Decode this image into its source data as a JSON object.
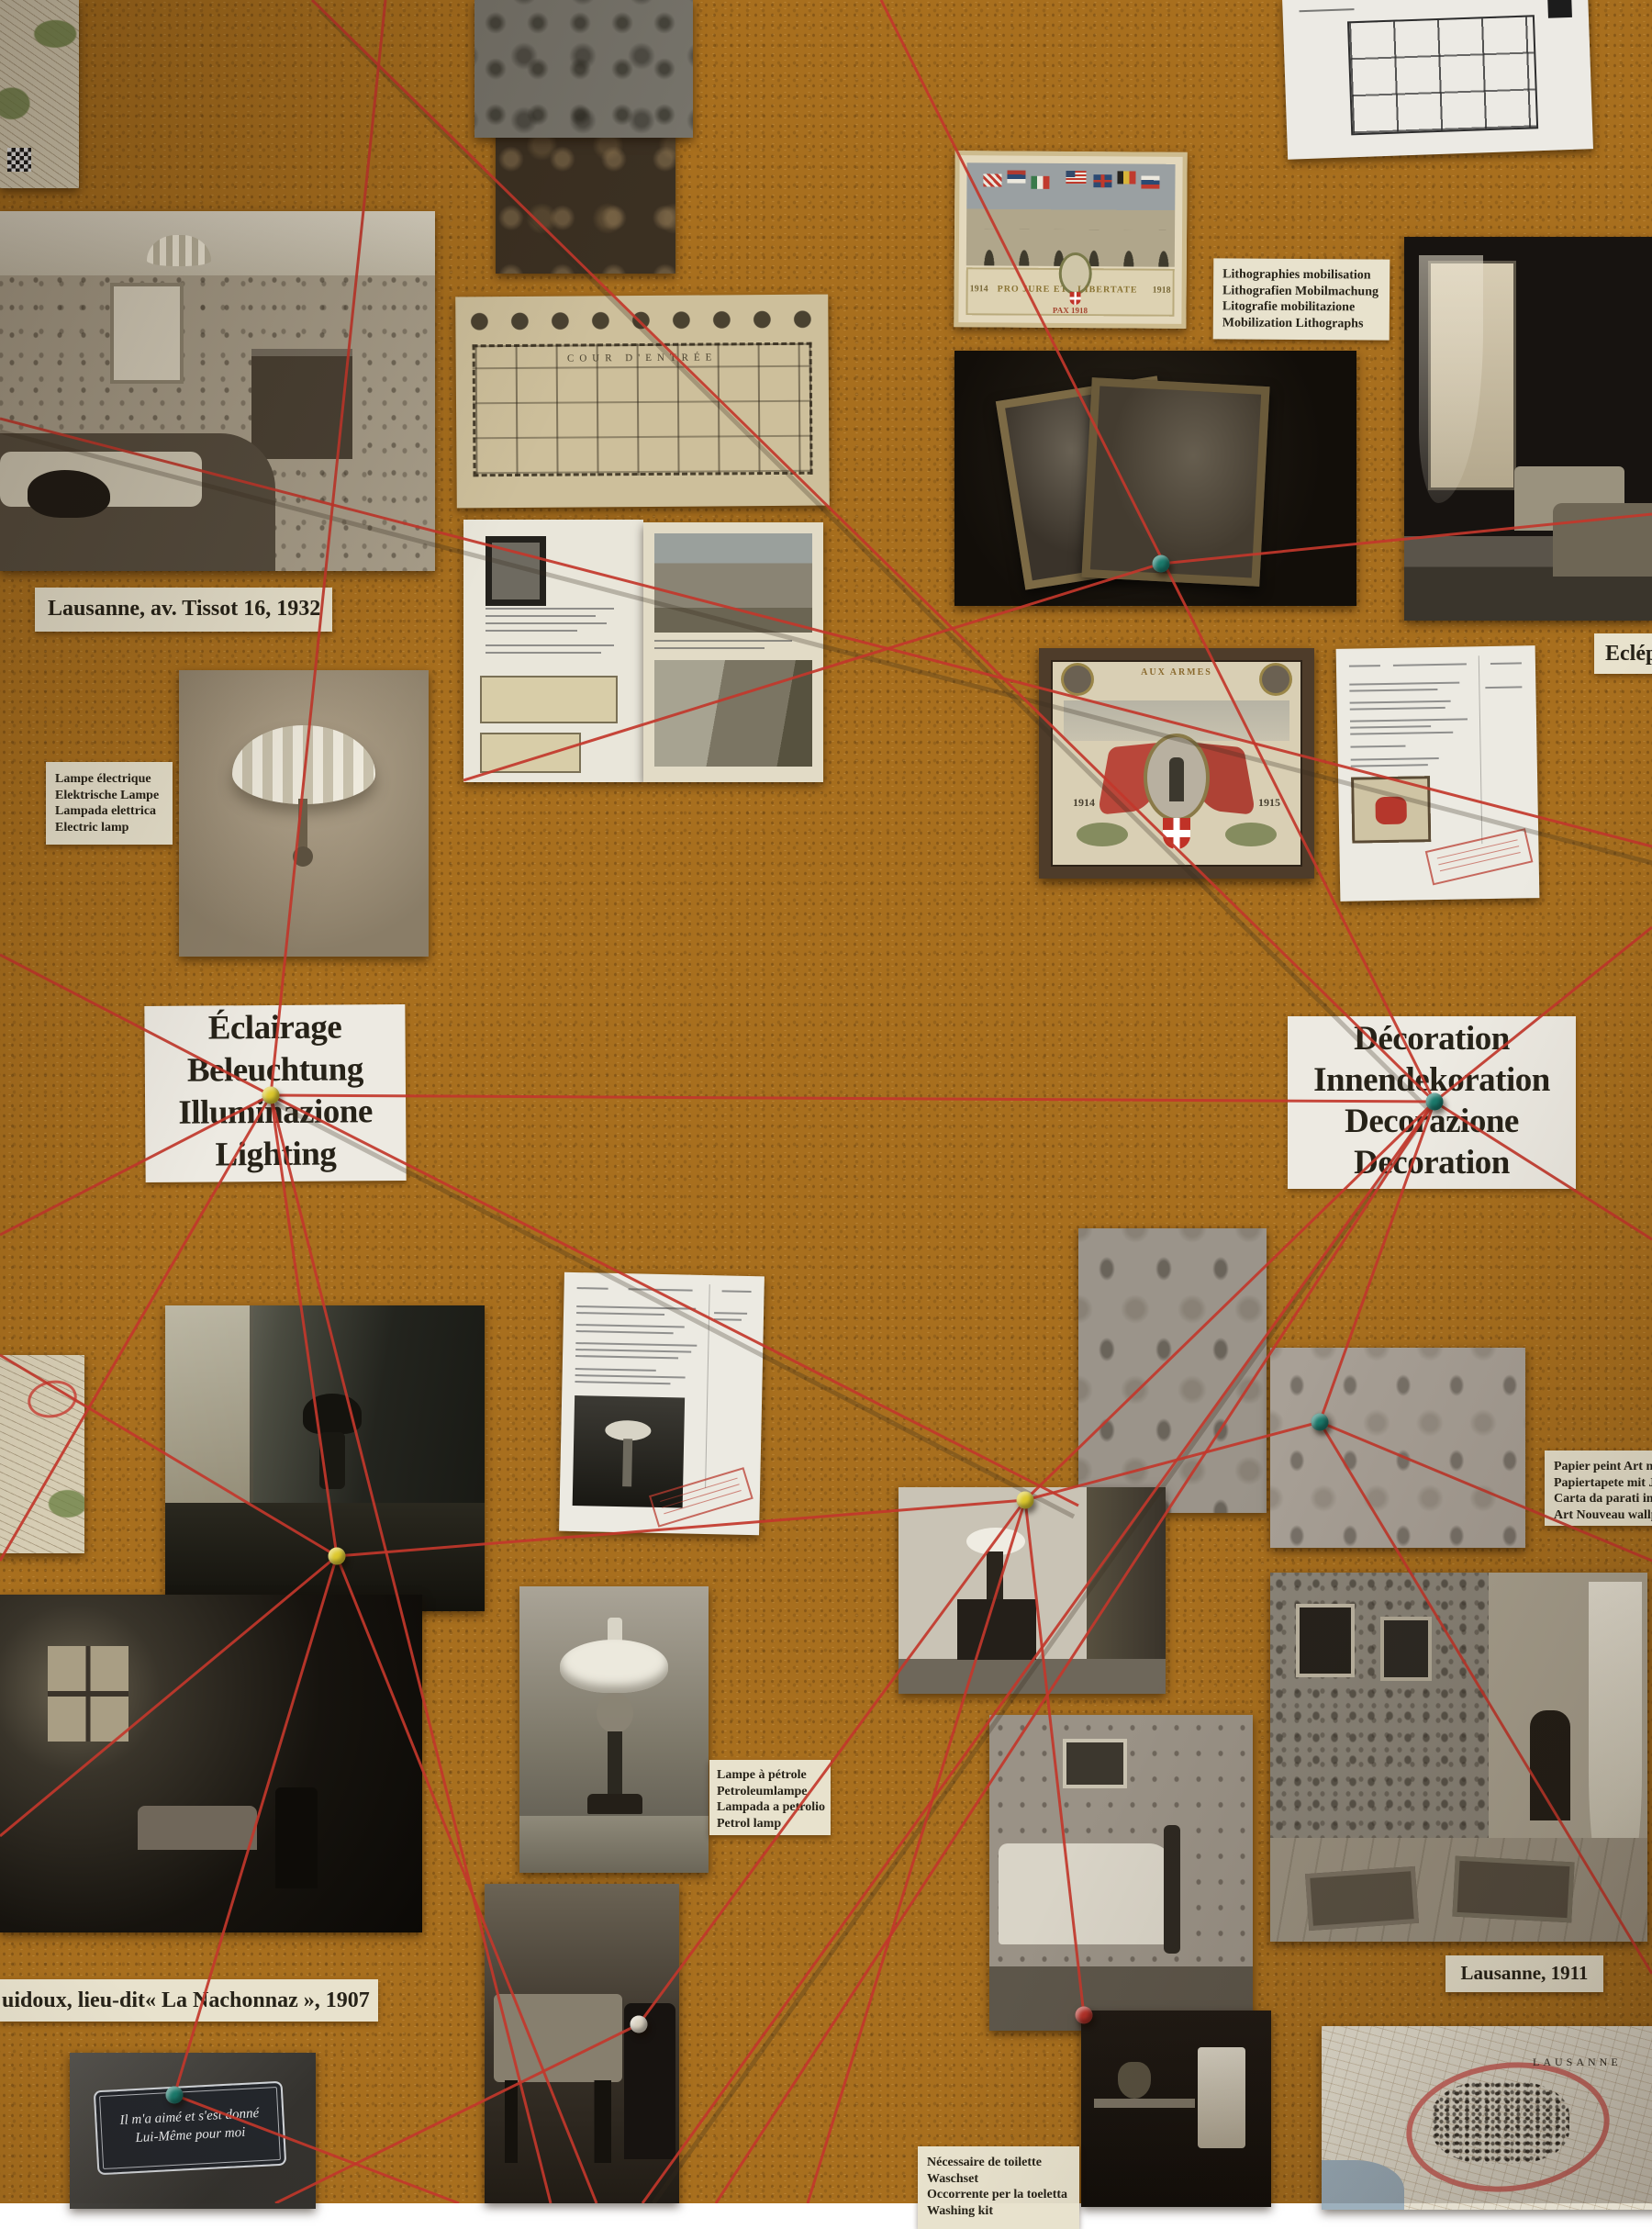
{
  "colors": {
    "cork": "#a86f1e",
    "string_red": "#c2372b",
    "pin_yellow": "#ddc92e",
    "pin_teal": "#1b7a6c",
    "pin_red": "#b23128",
    "pin_white": "#d8d0bf",
    "label_cream": "#e8e2cd",
    "label_white": "#edeae2"
  },
  "labels": {
    "lausanne_1932": "Lausanne, av. Tissot 16, 1932",
    "lampe_electrique": [
      "Lampe électrique",
      "Elektrische Lampe",
      "Lampada elettrica",
      "Electric lamp"
    ],
    "lithographies": [
      "Lithographies mobilisation",
      "Lithografien Mobilmachung",
      "Litografie mobilitazione",
      "Mobilization Lithographs"
    ],
    "eclairage": [
      "Éclairage",
      "Beleuchtung",
      "Illuminazione",
      "Lighting"
    ],
    "decoration": [
      "Décoration",
      "Innendekoration",
      "Decorazione",
      "Decoration"
    ],
    "eclepens": "Eclép",
    "papier_peint": [
      "Papier peint Art n",
      "Papiertapete mit J",
      "Carta da parati in",
      "Art Nouveau wallp"
    ],
    "lampe_petrole": [
      "Lampe à pétrole",
      "Petroleumlampe",
      "Lampada a petrolio",
      "Petrol lamp"
    ],
    "puidoux": "uidoux, lieu-dit« La Nachonnaz », 1907",
    "lausanne_1911": "Lausanne, 1911",
    "necessaire": [
      "Nécessaire de toilette",
      "Waschset",
      "Occorrente per la toeletta",
      "Washing kit"
    ]
  },
  "artifacts": {
    "floorplan_caption": "COUR  D'ENTRÉE",
    "litho": {
      "motto_left": "PRO JURE ET",
      "motto_right": "LIBERTATE",
      "year_left": "1914",
      "year_right": "1918",
      "pax": "PAX 1918"
    },
    "certificate": {
      "title": "AUX ARMES",
      "year_left": "1914",
      "year_right": "1915"
    },
    "plaque": [
      "Il m'a aimé et s'est donné",
      "Lui-Même pour moi"
    ],
    "map_city": "LAUSANNE"
  }
}
